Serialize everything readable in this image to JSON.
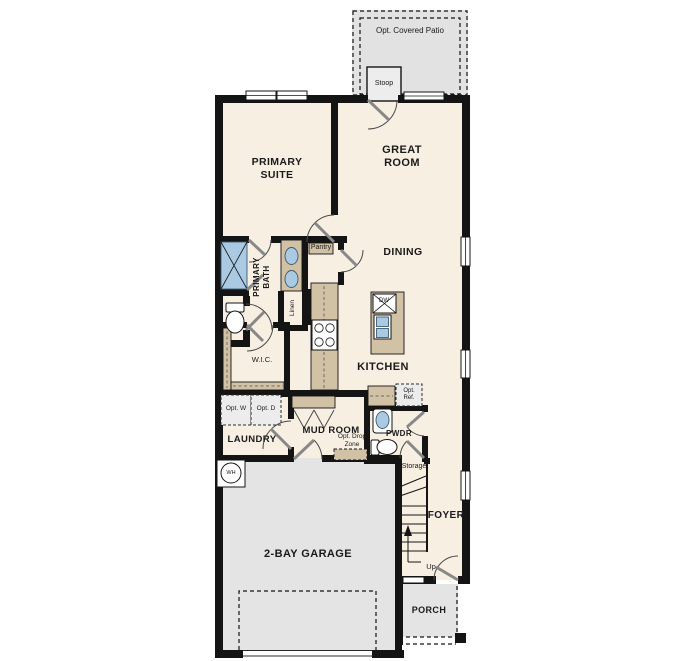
{
  "colors": {
    "wall": "#141414",
    "floor": "#f8efe3",
    "cabinet": "#d1c1a5",
    "fixture": "#aac9e2",
    "garage": "#e4e4e4",
    "optional": "#e2e2e2",
    "ink": "#1a1a1a"
  },
  "labels": {
    "opt_covered_patio": "Opt. Covered Patio",
    "stoop": "Stoop",
    "primary_suite": "PRIMARY SUITE",
    "great_room": "GREAT ROOM",
    "dining": "DINING",
    "primary_bath": "PRIMARY BATH",
    "pantry": "Pantry",
    "linen": "Linen",
    "wic": "W.I.C.",
    "kitchen": "KITCHEN",
    "dw": "DW",
    "opt_ref": "Opt. Ref.",
    "pwdr": "PWDR",
    "laundry": "LAUNDRY",
    "mud_room": "MUD ROOM",
    "opt_drop_zone": "Opt. Drop Zone",
    "opt_w": "Opt. W",
    "opt_d": "Opt. D",
    "storage": "Storage",
    "foyer": "FOYER",
    "up": "Up",
    "wh": "WH",
    "garage": "2-BAY GARAGE",
    "porch": "PORCH"
  }
}
